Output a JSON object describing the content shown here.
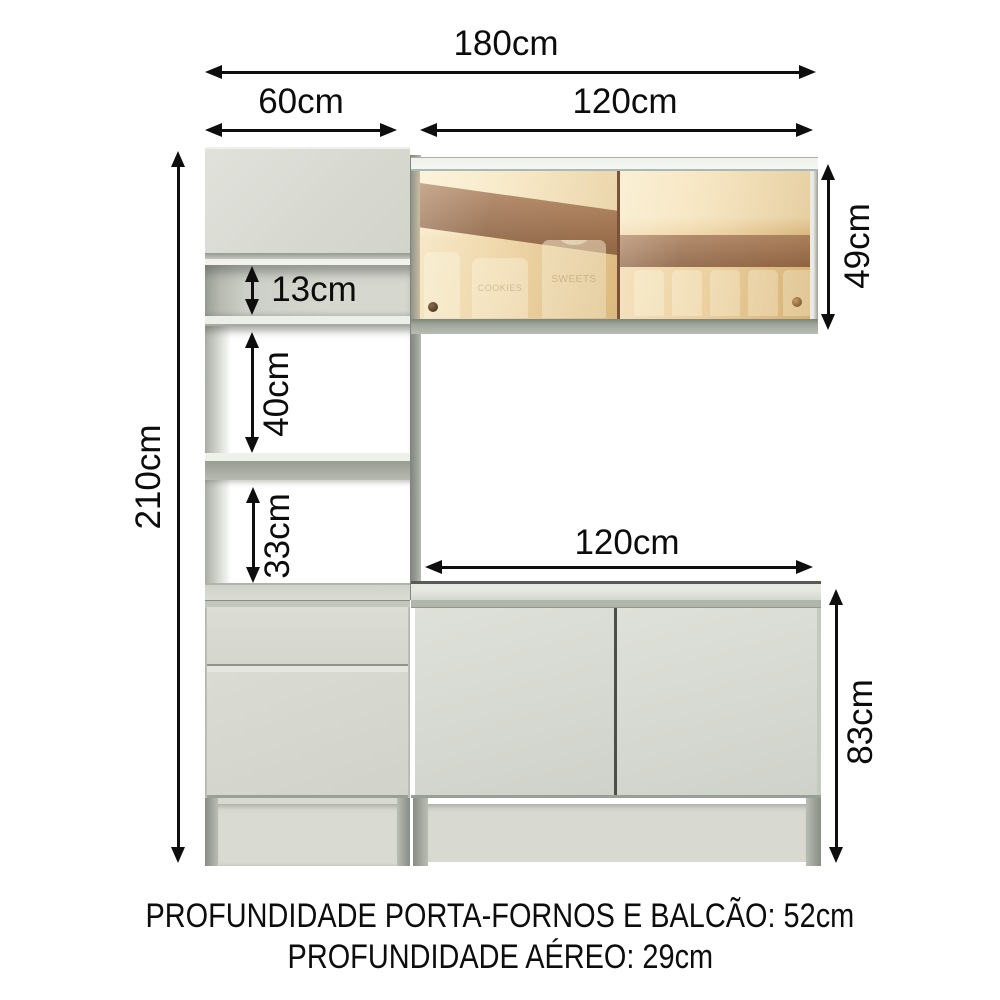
{
  "diagram": {
    "type": "furniture-dimension-diagram",
    "product": "kitchen cabinet set with tower, glass wall cabinet and counter",
    "dimensions": {
      "total_width": "180cm",
      "tower_width": "60cm",
      "upper_cabinet_width": "120cm",
      "counter_width": "120cm",
      "total_height": "210cm",
      "upper_cabinet_height": "49cm",
      "counter_height": "83cm",
      "top_niche_height": "13cm",
      "middle_niche_height": "40cm",
      "lower_niche_height": "33cm"
    },
    "jar_labels": {
      "jar1": "COOKIES",
      "jar2": "SWEETS"
    },
    "footer": {
      "line1": "PROFUNDIDADE PORTA-FORNOS E BALCÃO: 52cm",
      "line2": "PROFUNDIDADE AÉREO: 29cm"
    },
    "colors": {
      "background": "#ffffff",
      "cabinet_body": "#d8dad2",
      "glass_amber": "#ecd2a0",
      "glass_reflection_brown": "#96694c",
      "arrow_and_text": "#0e0e0e"
    }
  }
}
